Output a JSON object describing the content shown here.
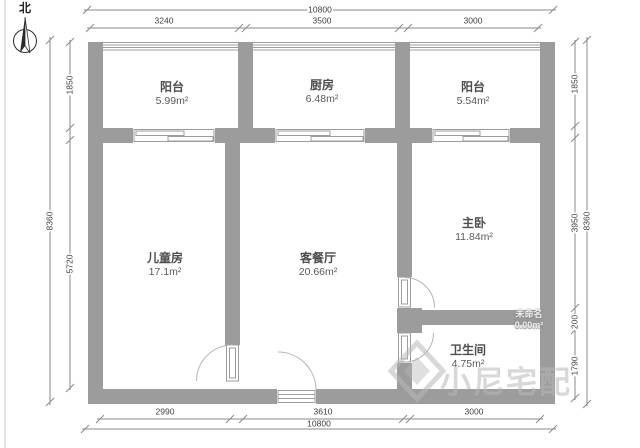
{
  "north": {
    "label": "北"
  },
  "dimensions": {
    "top": {
      "total": "10800",
      "segments": [
        "3240",
        "3500",
        "3000"
      ]
    },
    "bottom": {
      "total": "10800",
      "segments": [
        "2990",
        "3610",
        "3000"
      ]
    },
    "left": {
      "total": "8360",
      "segments": [
        "1850",
        "5720"
      ]
    },
    "right": {
      "total": "8360",
      "segments": [
        "1850",
        "3950",
        "200",
        "1790"
      ]
    }
  },
  "rooms": {
    "balcony_left": {
      "name": "阳台",
      "area": "5.99m²"
    },
    "kitchen": {
      "name": "厨房",
      "area": "6.48m²"
    },
    "balcony_right": {
      "name": "阳台",
      "area": "5.54m²"
    },
    "kids_room": {
      "name": "儿童房",
      "area": "17.1m²"
    },
    "living_dining": {
      "name": "客餐厅",
      "area": "20.66m²"
    },
    "master_bedroom": {
      "name": "主卧",
      "area": "11.84m²"
    },
    "bathroom": {
      "name": "卫生间",
      "area": "4.75m²"
    },
    "unnamed": {
      "name": "未命名",
      "area": "0.00m²"
    }
  },
  "watermark": {
    "brand": "小尼宅配"
  },
  "colors": {
    "wall": "#9c9c9c",
    "dimension_line": "#8a8a8a",
    "dimension_text": "#3f3f3f",
    "room_text": "#4d4d4d",
    "watermark": "rgba(184,184,184,0.55)"
  }
}
